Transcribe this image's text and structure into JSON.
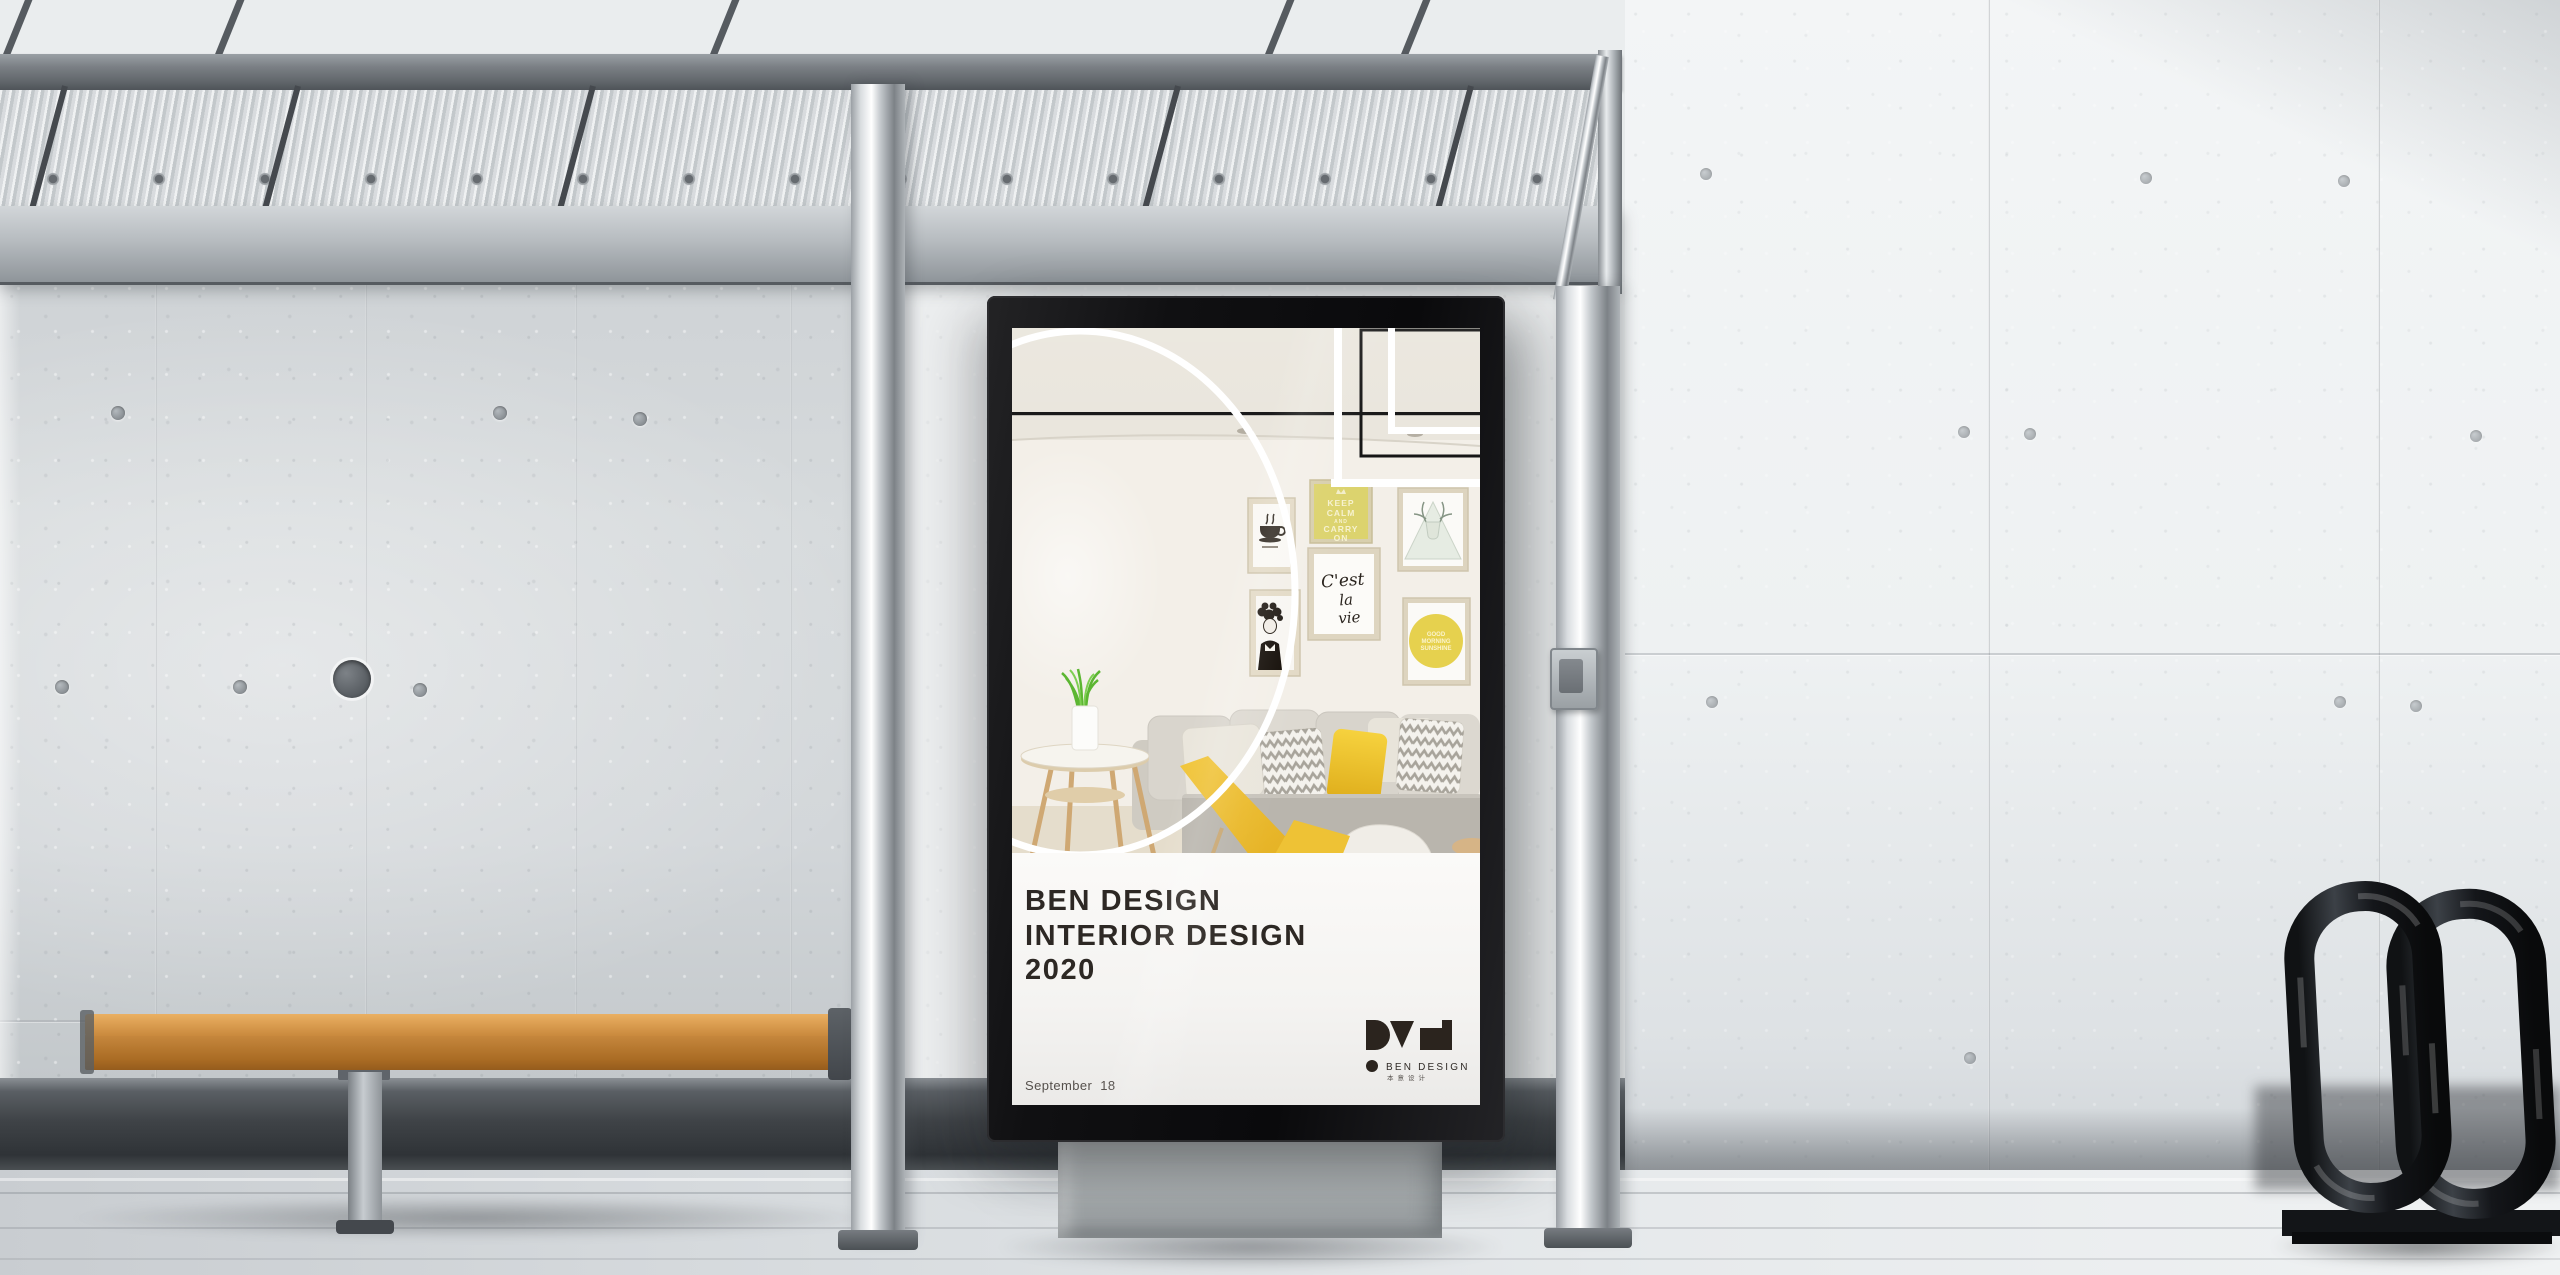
{
  "poster": {
    "title_lines": [
      "BEN DESIGN",
      "INTERIOR DESIGN",
      "2020"
    ],
    "date_lines": [
      "September  18",
      "2020"
    ],
    "logo": {
      "name": "BEN DESIGN",
      "chinese": "本意设计"
    },
    "wall_art": {
      "keep_calm": [
        "KEEP",
        "CALM",
        "AND",
        "CARRY",
        "ON"
      ],
      "cest_la_vie": [
        "C'est",
        "la",
        "vie"
      ],
      "sunshine": [
        "GOOD",
        "MORNING",
        "SUNSHINE"
      ]
    },
    "colors": {
      "accent_yellow": "#f0c63a",
      "lightbox_frame": "#121214",
      "band_white": "#f8f7f5",
      "title_text": "#2d2824",
      "keep_calm_frame": "#d9cf6b",
      "bench_wood": "#c8893f"
    }
  }
}
